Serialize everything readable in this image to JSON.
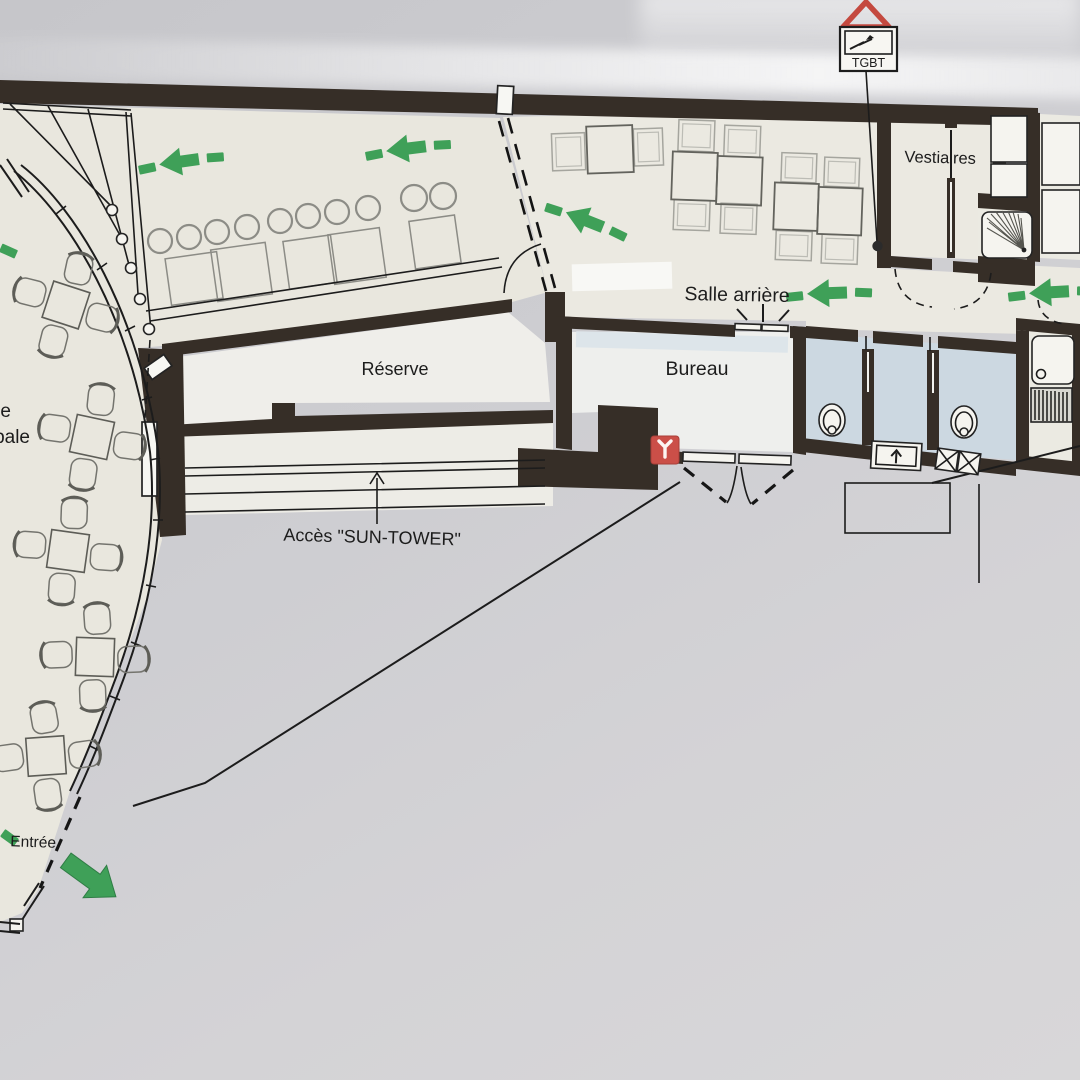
{
  "plan": {
    "labels": {
      "vestiaires": "Vestiaires",
      "salle_arriere": "Salle arrière",
      "bureau": "Bureau",
      "reserve": "Réserve",
      "acces_sun_tower": "Accès \"SUN-TOWER\"",
      "entree": "Entrée",
      "salle_principale_cut_line1": "e",
      "salle_principale_cut_line2": "pale"
    },
    "electrical_sign": {
      "label": "TGBT"
    },
    "colors": {
      "wall": "#362e27",
      "floor_main": "#e9e7de",
      "floor_back_room": "#ebe9e1",
      "floor_white_rooms": "#efeeea",
      "floor_wc_blue": "#ccd8e1",
      "evacuation_green": "#3fa058",
      "alarm_red": "#cb4f48",
      "warning_red": "#c4493f",
      "paper_grey": "#cfcfd3",
      "ink": "#1c1c1c"
    },
    "icons": {
      "warning-triangle-icon": "red outlined triangle",
      "lightning-arrow-icon": "electrical flash arrow",
      "fire-extinguisher-icon": "red square with white Y",
      "evacuation-arrow-icon": "green dashed left arrow",
      "entrance-arrow-icon": "solid green arrow",
      "shower-icon": "square with fan lines",
      "toilet-icon": "oval bowl",
      "urinal-icon": "box with up arrow",
      "sink-icon": "basin with drainboard",
      "stairs-icon": "fan of tread lines"
    }
  }
}
